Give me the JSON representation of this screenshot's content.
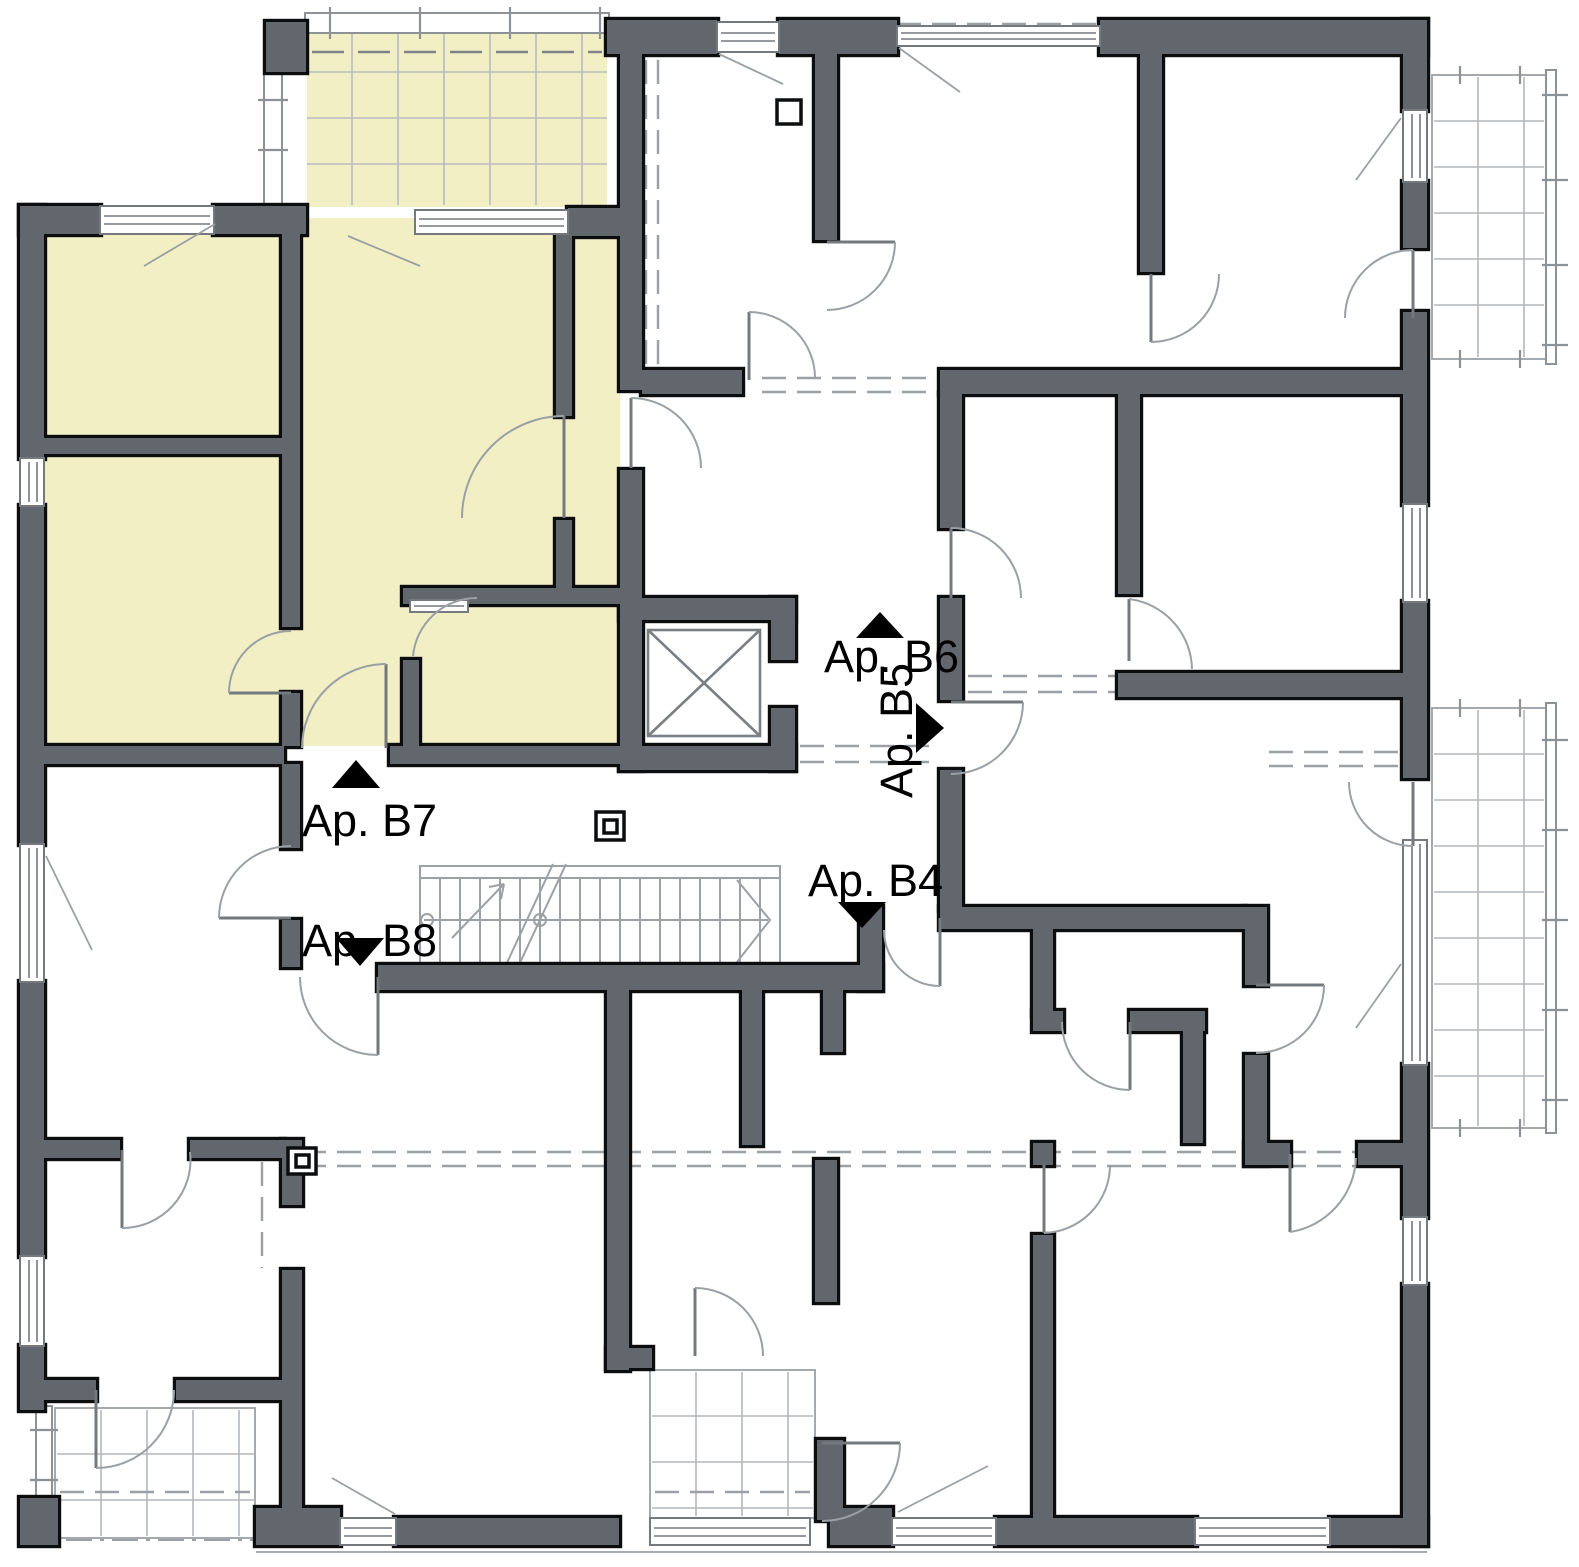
{
  "plan": {
    "type": "architectural-floor-plan",
    "units": [
      {
        "id": "B7",
        "label": "Ap. B7",
        "marker_direction": "up",
        "highlighted": true
      },
      {
        "id": "B8",
        "label": "Ap. B8",
        "marker_direction": "down",
        "highlighted": false
      },
      {
        "id": "B6",
        "label": "Ap. B6",
        "marker_direction": "up",
        "highlighted": false
      },
      {
        "id": "B5",
        "label": "Ap. B5",
        "marker_direction": "right",
        "highlighted": false,
        "label_rotated": true
      },
      {
        "id": "B4",
        "label": "Ap. B4",
        "marker_direction": "down",
        "highlighted": false
      }
    ],
    "features": {
      "elevator": "elevator-shaft-with-cross",
      "staircase": "straight-run-stair-with-break-line",
      "balconies": [
        "top-balcony-highlighted",
        "right-upper-balcony",
        "right-lower-balcony",
        "bottom-left-terrace",
        "entry-lobby-tiled"
      ]
    },
    "colors": {
      "wall_fill": "#62676e",
      "wall_outline": "#0c0d0e",
      "highlight_fill": "#f2efc5",
      "line_gray": "#9aa0a4",
      "background": "#ffffff",
      "label_color": "#000000"
    }
  }
}
